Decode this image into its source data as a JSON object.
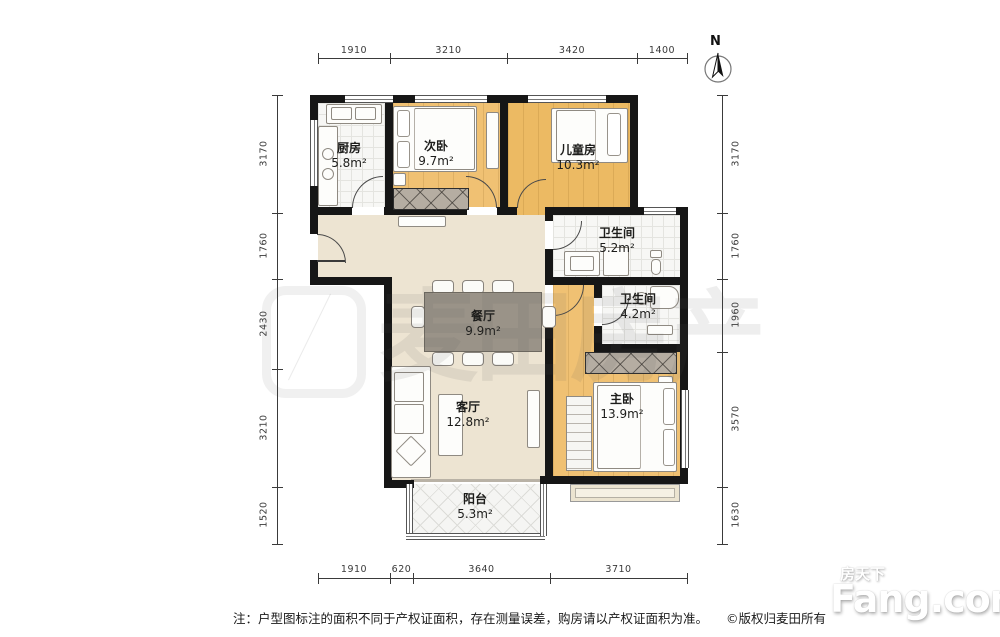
{
  "plan": {
    "north_label": "N",
    "rooms": {
      "kitchen": {
        "name": "厨房",
        "area": "5.8m²"
      },
      "bedroom2": {
        "name": "次卧",
        "area": "9.7m²"
      },
      "kids": {
        "name": "儿童房",
        "area": "10.3m²"
      },
      "bath1": {
        "name": "卫生间",
        "area": "5.2m²"
      },
      "bath2": {
        "name": "卫生间",
        "area": "4.2m²"
      },
      "dining": {
        "name": "餐厅",
        "area": "9.9m²"
      },
      "living": {
        "name": "客厅",
        "area": "12.8m²"
      },
      "master": {
        "name": "主卧",
        "area": "13.9m²"
      },
      "balcony": {
        "name": "阳台",
        "area": "5.3m²"
      }
    },
    "dimensions": {
      "top": [
        "1910",
        "3210",
        "3420",
        "1400"
      ],
      "bottom": [
        "1910",
        "620",
        "3640",
        "3710"
      ],
      "left": [
        "3170",
        "1760",
        "2430",
        "3210",
        "1520"
      ],
      "right": [
        "3170",
        "1760",
        "1960",
        "3570",
        "1630"
      ]
    }
  },
  "footer": {
    "note": "注：户型图标注的面积不同于产权证面积，存在测量误差，购房请以产权证面积为准。",
    "copyright": "©版权归麦田所有"
  },
  "watermarks": {
    "center_text": "麦田房产",
    "brand_cn": "房天下",
    "brand_en": "Fang.com"
  },
  "colors": {
    "wall": "#161616",
    "wood_floor": "#f0c173",
    "tile_floor": "#f7f7f5",
    "living_floor": "#ede4d2",
    "wardrobe": "#b5ada2"
  }
}
